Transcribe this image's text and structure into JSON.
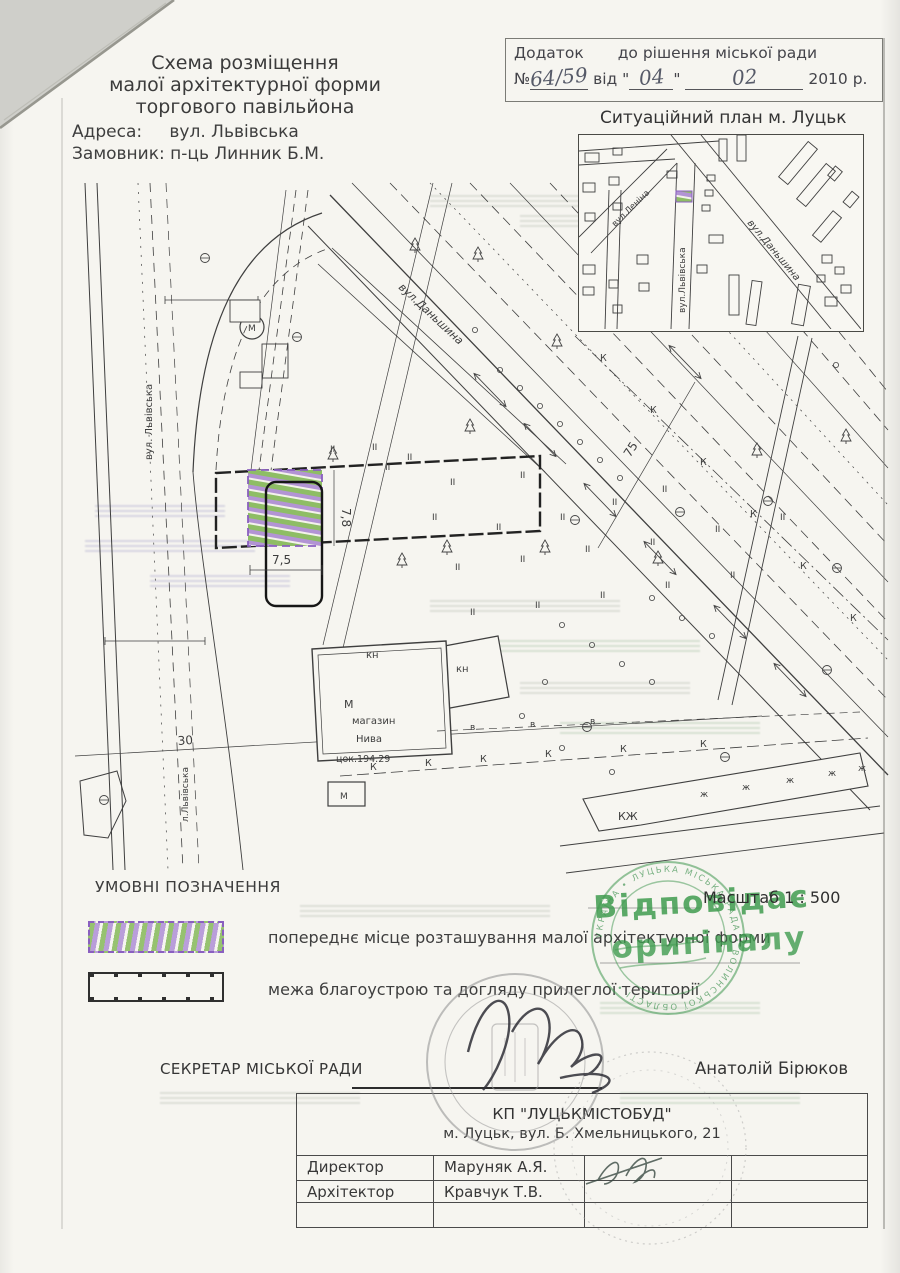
{
  "document": {
    "header": {
      "title_lines": [
        "Схема розміщення",
        "малої архітектурної форми",
        "торгового павільйона"
      ],
      "address_label": "Адреса:",
      "address_value": "вул. Львівська",
      "client_label": "Замовник:",
      "client_value": "п-ць Линник Б.М."
    },
    "annex": {
      "word1": "Додаток",
      "word2": "до рішення міської ради",
      "no_sign": "№",
      "number": "64/59",
      "vid": "від",
      "quote": "\"",
      "day": "04",
      "month": "02",
      "year": "2010 р."
    },
    "inset": {
      "title": "Ситуаційний план м. Луцьк",
      "street_danshyna": "вул.Даньшина",
      "street_lvivska": "вул.Львівська",
      "street_lenina": "вул.Леніна"
    },
    "legend": {
      "title": "УМОВНІ ПОЗНАЧЕННЯ",
      "item1": "попереднє місце розташування малої архітектурної форми",
      "item2": "межа благоустрою та догляду прилеглої території"
    },
    "scale": "Масштаб 1 : 500",
    "stamp": {
      "line1": "Відповідає",
      "line2": "оригіналу",
      "ring_text": "УКРАЇНА • ЛУЦЬКА МІСЬКА РАДА • ВОЛИНСЬКОЇ ОБЛАСТІ •",
      "color": "#3f9b4f"
    },
    "secretary": {
      "label": "СЕКРЕТАР МІСЬКОЇ РАДИ",
      "name": "Анатолій Бірюков"
    },
    "titleblock": {
      "company": "КП \"ЛУЦЬКМІСТОБУД\"",
      "address": "м. Луцьк, вул. Б. Хмельницького, 21",
      "rows": [
        {
          "role": "Директор",
          "name": "Маруняк А.Я."
        },
        {
          "role": "Архітектор",
          "name": "Кравчук Т.В."
        }
      ]
    }
  },
  "plan": {
    "labels": {
      "street_danshyna": "вул.Даньшина",
      "street_lvivska": "вул. Львівська",
      "street_lvivska_small": "л.Львівська",
      "dim_78": "7,8",
      "dim_75w": "7,5",
      "dim_30": "30",
      "dim_75": "75",
      "kn1": "кн",
      "kn2": "кн",
      "m_big": "М",
      "shop1": "магазин",
      "shop2": "Нива",
      "tsok": "цок.194.29",
      "m_small": "М",
      "m_circle": "М",
      "kzh": "КЖ"
    },
    "symbols": {
      "trees": [
        [
          333,
          456
        ],
        [
          402,
          562
        ],
        [
          447,
          549
        ],
        [
          470,
          428
        ],
        [
          545,
          549
        ],
        [
          658,
          560
        ],
        [
          757,
          452
        ],
        [
          846,
          438
        ],
        [
          415,
          247
        ],
        [
          478,
          256
        ],
        [
          557,
          343
        ]
      ],
      "manholes": [
        [
          575,
          520
        ],
        [
          680,
          512
        ],
        [
          768,
          501
        ],
        [
          837,
          568
        ],
        [
          827,
          670
        ],
        [
          587,
          727
        ],
        [
          205,
          258
        ],
        [
          297,
          337
        ],
        [
          104,
          800
        ],
        [
          725,
          757
        ]
      ],
      "dots": [
        [
          500,
          370
        ],
        [
          520,
          388
        ],
        [
          540,
          406
        ],
        [
          560,
          424
        ],
        [
          580,
          442
        ],
        [
          600,
          460
        ],
        [
          620,
          478
        ],
        [
          562,
          625
        ],
        [
          592,
          645
        ],
        [
          622,
          664
        ],
        [
          652,
          682
        ],
        [
          545,
          682
        ],
        [
          522,
          716
        ],
        [
          562,
          748
        ],
        [
          612,
          772
        ],
        [
          836,
          365
        ],
        [
          652,
          598
        ],
        [
          682,
          618
        ],
        [
          712,
          636
        ],
        [
          475,
          330
        ]
      ],
      "grass_glyph": "II",
      "grass": [
        [
          385,
          470
        ],
        [
          450,
          485
        ],
        [
          520,
          478
        ],
        [
          432,
          520
        ],
        [
          496,
          530
        ],
        [
          560,
          520
        ],
        [
          612,
          505
        ],
        [
          662,
          492
        ],
        [
          455,
          570
        ],
        [
          520,
          562
        ],
        [
          585,
          552
        ],
        [
          650,
          545
        ],
        [
          715,
          532
        ],
        [
          780,
          520
        ],
        [
          470,
          615
        ],
        [
          535,
          608
        ],
        [
          600,
          598
        ],
        [
          665,
          588
        ],
        [
          730,
          578
        ],
        [
          330,
          452
        ],
        [
          372,
          450
        ],
        [
          407,
          460
        ]
      ],
      "sewer_glyph": "К",
      "sewer_marks": [
        [
          600,
          361
        ],
        [
          650,
          413
        ],
        [
          700,
          465
        ],
        [
          750,
          517
        ],
        [
          800,
          569
        ],
        [
          850,
          621
        ],
        [
          370,
          770
        ],
        [
          425,
          766
        ],
        [
          480,
          762
        ],
        [
          545,
          757
        ],
        [
          620,
          752
        ],
        [
          700,
          747
        ]
      ],
      "water_glyph": "в",
      "water_marks": [
        [
          470,
          730
        ],
        [
          530,
          727
        ],
        [
          590,
          724
        ]
      ],
      "kzh_glyph": "ж",
      "kzh_marks": [
        [
          700,
          797
        ],
        [
          742,
          790
        ],
        [
          786,
          783
        ],
        [
          828,
          776
        ],
        [
          858,
          771
        ]
      ],
      "arrows": [
        [
          490,
          390,
          46
        ],
        [
          540,
          440,
          46
        ],
        [
          600,
          500,
          46
        ],
        [
          660,
          558,
          46
        ],
        [
          730,
          622,
          46
        ],
        [
          790,
          680,
          46
        ],
        [
          625,
          302,
          46
        ],
        [
          685,
          362,
          46
        ]
      ]
    },
    "inset_buildings": [
      [
        6,
        18,
        14,
        9,
        0
      ],
      [
        34,
        13,
        9,
        7,
        0
      ],
      [
        4,
        48,
        12,
        9,
        0
      ],
      [
        30,
        42,
        10,
        8,
        0
      ],
      [
        6,
        78,
        10,
        8,
        0
      ],
      [
        34,
        68,
        9,
        7,
        0
      ],
      [
        4,
        130,
        12,
        9,
        0
      ],
      [
        4,
        152,
        11,
        8,
        0
      ],
      [
        30,
        145,
        9,
        8,
        0
      ],
      [
        58,
        120,
        11,
        9,
        0
      ],
      [
        60,
        148,
        10,
        8,
        0
      ],
      [
        34,
        170,
        9,
        8,
        0
      ],
      [
        88,
        36,
        10,
        7,
        0
      ],
      [
        128,
        40,
        8,
        6,
        0
      ],
      [
        126,
        55,
        8,
        6,
        0
      ],
      [
        123,
        70,
        8,
        6,
        0
      ],
      [
        130,
        100,
        14,
        8,
        0
      ],
      [
        118,
        130,
        10,
        8,
        0
      ],
      [
        140,
        4,
        8,
        22,
        0
      ],
      [
        158,
        0,
        9,
        26,
        0
      ],
      [
        196,
        22,
        46,
        12,
        -50
      ],
      [
        214,
        44,
        46,
        12,
        -50
      ],
      [
        232,
        86,
        32,
        11,
        -50
      ],
      [
        243,
        120,
        10,
        8,
        0
      ],
      [
        256,
        132,
        9,
        7,
        0
      ],
      [
        238,
        140,
        8,
        7,
        0
      ],
      [
        262,
        150,
        10,
        8,
        0
      ],
      [
        246,
        162,
        12,
        9,
        0
      ],
      [
        265,
        60,
        14,
        9,
        -50
      ],
      [
        250,
        34,
        12,
        9,
        -50
      ],
      [
        150,
        140,
        10,
        40,
        0
      ],
      [
        170,
        146,
        10,
        44,
        8
      ],
      [
        216,
        150,
        12,
        40,
        10
      ]
    ],
    "scan_artifacts": [
      [
        430,
        195,
        170,
        ""
      ],
      [
        520,
        215,
        200,
        ""
      ],
      [
        600,
        252,
        150,
        ""
      ],
      [
        640,
        282,
        180,
        ""
      ],
      [
        95,
        505,
        130,
        "p"
      ],
      [
        85,
        540,
        170,
        "p"
      ],
      [
        150,
        575,
        140,
        "p"
      ],
      [
        430,
        600,
        190,
        ""
      ],
      [
        490,
        640,
        210,
        "g"
      ],
      [
        520,
        682,
        170,
        ""
      ],
      [
        560,
        722,
        200,
        "g"
      ],
      [
        600,
        796,
        150,
        ""
      ],
      [
        300,
        905,
        250,
        ""
      ],
      [
        600,
        1002,
        160,
        "g"
      ],
      [
        160,
        1092,
        200,
        ""
      ],
      [
        620,
        1092,
        180,
        "g"
      ]
    ]
  }
}
